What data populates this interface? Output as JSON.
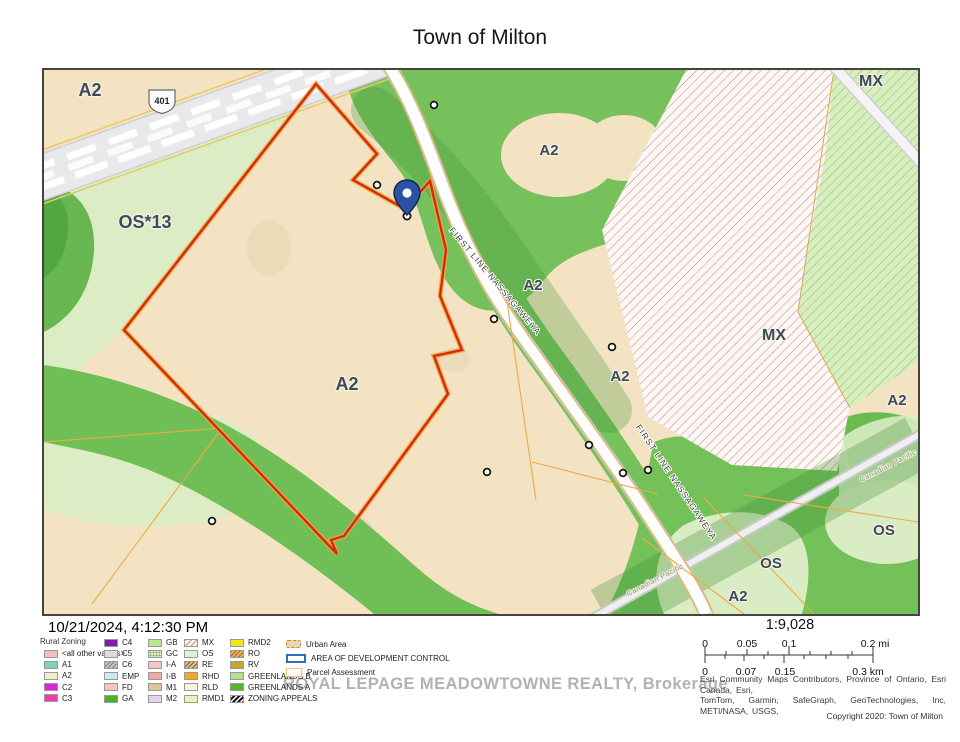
{
  "title": "Town of Milton",
  "timestamp": "10/21/2024, 4:12:30 PM",
  "watermark": "ROYAL LEPAGE MEADOWTOWNE REALTY, Brokerage",
  "scale": {
    "ratio": "1:9,028",
    "mi": [
      "0",
      "0.05",
      "0.1",
      "0.2 mi"
    ],
    "km": [
      "0",
      "0.07",
      "0.15",
      "0.3 km"
    ]
  },
  "attribution": {
    "line1": "Esri Community Maps Contributors, Province of Ontario, Esri Canada, Esri,",
    "line2": "TomTom, Garmin, SafeGraph, GeoTechnologies, Inc, METI/NASA, USGS,"
  },
  "copyright": "Copyright 2020: Town of Milton",
  "map_labels": {
    "a2": "A2",
    "os13": "OS*13",
    "mx": "MX",
    "os": "OS",
    "road": "FIRST LINE NASSAGAWEYA",
    "railway": "Canadian Pacific",
    "highway_shield": "401"
  },
  "map_colors": {
    "a2_fill": "#f3e3c3",
    "open_space_fill": "#dcedc5",
    "greenlands_fill": "#77c15d",
    "subject_parcel_outline": "#d22b11",
    "parcel_line": "#f0a83c",
    "road_fill": "#ffffff",
    "highway_fill": "#e9e9ec",
    "pin": "#2b51a3"
  },
  "legend": {
    "title": "Rural Zoning",
    "col1": [
      {
        "label": "<all other values>",
        "color": "#f6bdbd"
      },
      {
        "label": "A1",
        "color": "#7fd3ae"
      },
      {
        "label": "A2",
        "color": "#f7ebcd"
      },
      {
        "label": "C2",
        "color": "#dd22dd"
      },
      {
        "label": "C3",
        "color": "#ee3fa2"
      }
    ],
    "col2": [
      {
        "label": "C4",
        "color": "#7b1fa0"
      },
      {
        "label": "C5",
        "color": "#dcdcdc"
      },
      {
        "label": "C6",
        "color": "#c6c6c6",
        "pattern": "diag-gray"
      },
      {
        "label": "EMP",
        "color": "#cfe6f7"
      },
      {
        "label": "FD",
        "color": "#f2c6bb"
      },
      {
        "label": "GA",
        "color": "#4ab22a"
      }
    ],
    "col3": [
      {
        "label": "GB",
        "color": "#b7e98c"
      },
      {
        "label": "GC",
        "color": "#e3efcd",
        "pattern": "dots-green"
      },
      {
        "label": "I-A",
        "color": "#f6c6c6"
      },
      {
        "label": "I-B",
        "color": "#f2a9a4"
      },
      {
        "label": "M1",
        "color": "#d9c69d"
      },
      {
        "label": "M2",
        "color": "#e0d3f2"
      }
    ],
    "col4": [
      {
        "label": "MX",
        "color": "#faf6f2",
        "pattern": "diag-tan"
      },
      {
        "label": "OS",
        "color": "#e2f0d4"
      },
      {
        "label": "RE",
        "color": "#d8c888",
        "pattern": "diag-olive"
      },
      {
        "label": "RHD",
        "color": "#f5a81f"
      },
      {
        "label": "RLD",
        "color": "#faf3dc"
      },
      {
        "label": "RMD1",
        "color": "#eff0bd"
      }
    ],
    "col5": [
      {
        "label": "RMD2",
        "color": "#f2e717"
      },
      {
        "label": "RO",
        "color": "#e8b45e",
        "pattern": "diag-orange"
      },
      {
        "label": "RV",
        "color": "#c7a52d"
      },
      {
        "label": "GREENLANDS B",
        "color": "#b4e38c"
      },
      {
        "label": "GREENLANDS A",
        "color": "#53b42f"
      },
      {
        "label": "ZONING APPEALS",
        "color": "#1a1a1a",
        "pattern": "diag-white"
      }
    ],
    "col6": [
      {
        "label": "Urban Area",
        "color": "#ead9b0",
        "pattern": "urban"
      },
      {
        "label": "AREA OF DEVELOPMENT CONTROL",
        "pattern": "adc"
      },
      {
        "label": "Parcel Assessment",
        "pattern": "parcel"
      }
    ]
  }
}
